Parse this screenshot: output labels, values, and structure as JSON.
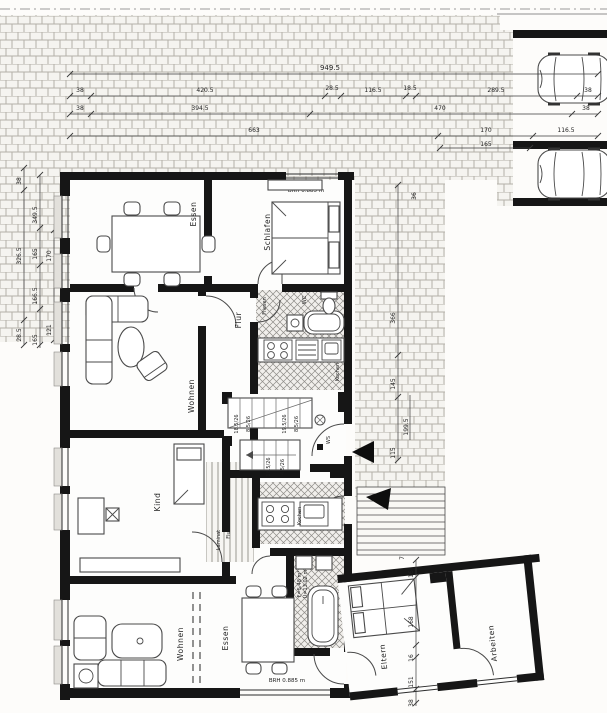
{
  "document": {
    "kind": "scanned architectural floor plan (Grundriss), black/white",
    "wall_color": "#161616",
    "paper_color": "#fdfcfa"
  },
  "labels": {
    "essen_upper": "Essen",
    "schlafen": "Schlafen",
    "wohnen_upper": "Wohnen",
    "flur_upper": "Flur",
    "fliesen": "Fliesen",
    "wc": "WC",
    "kochen_upper": "Kochen",
    "kind": "Kind",
    "flur_lower": "Flur",
    "laminat": "Laminat",
    "kochen_lower": "Kochen",
    "bad_f": "F=5.48 m²",
    "bad_u": "U=13.02 m",
    "wohnen_lower": "Wohnen",
    "essen_lower": "Essen",
    "eltern": "Eltern",
    "arbeiten": "Arbeiten",
    "ws": "WS",
    "brh_top": "BRH 0.885 m",
    "brh_bottom": "BRH 0.885 m"
  },
  "dims": {
    "total": "949.5",
    "row2": [
      "38",
      "420.5",
      "28.5",
      "116.5",
      "18.5",
      "289.5",
      "38"
    ],
    "row3": [
      "38",
      "394.5",
      "470",
      "38"
    ],
    "row4": [
      "663",
      "170",
      "165",
      "116.5"
    ],
    "left_outer": [
      "38",
      "326.5",
      "28.5"
    ],
    "left_inner": [
      "349.5",
      "165",
      "166.5",
      "165"
    ],
    "left_inner2": [
      "170",
      "121"
    ],
    "right": [
      "36",
      "366",
      "145",
      "199.5",
      "115"
    ],
    "right_step": "71",
    "annex": [
      "16",
      "168",
      "16",
      "151",
      "38"
    ],
    "steps_upper": [
      "18.5/26",
      "8.5/26",
      "19.5/26",
      "8.5/26"
    ],
    "steps_lower": [
      "4.5/26",
      "18.5/26"
    ]
  }
}
